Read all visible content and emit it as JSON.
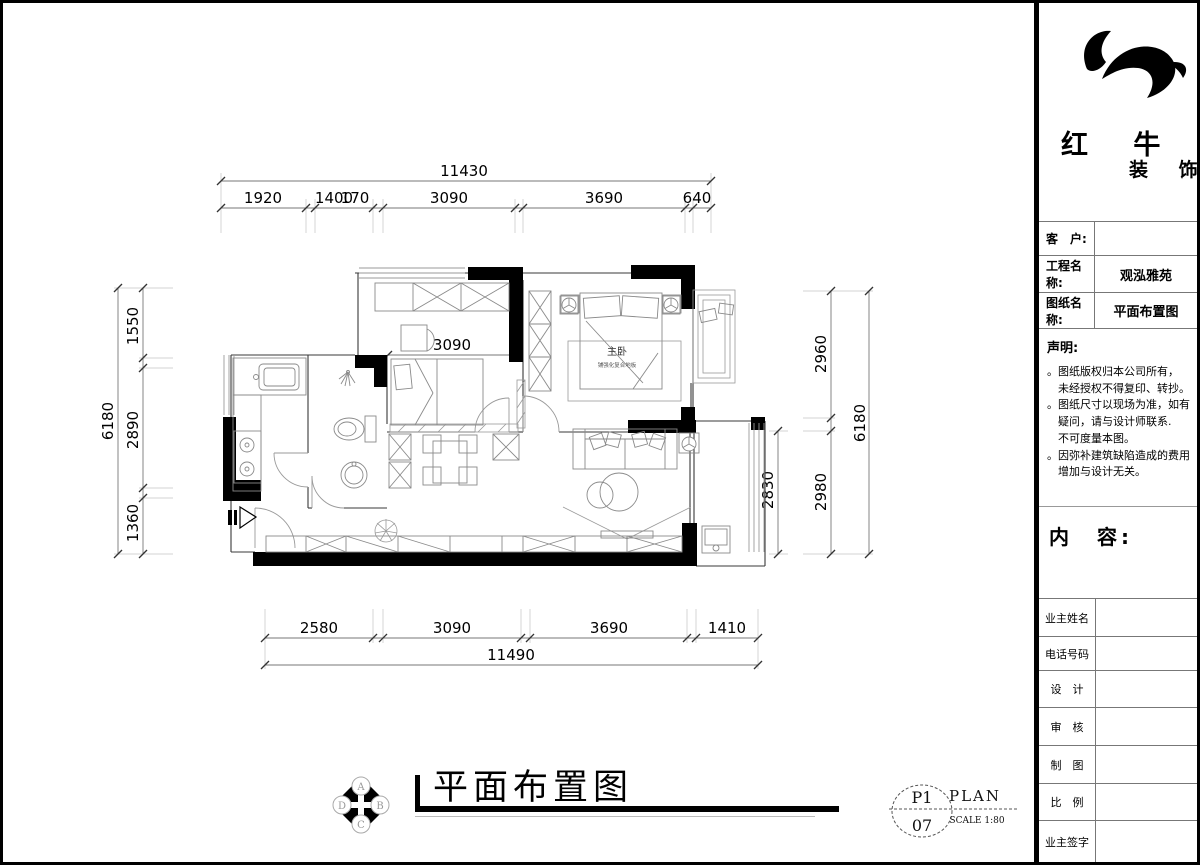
{
  "colors": {
    "ink": "#000000",
    "line_gray": "#8a8a8a",
    "bg": "#ffffff"
  },
  "plan": {
    "room_labels": {
      "master": "主卧",
      "master_sub": "铺强化复合地板"
    },
    "dims": {
      "top_total": "11430",
      "top_segs": [
        "1920",
        "1400",
        "170",
        "3090",
        "3690",
        "640"
      ],
      "bottom_segs": [
        "2580",
        "3090",
        "3690",
        "1410"
      ],
      "bottom_total": "11490",
      "left_total": "6180",
      "left_segs": [
        "1550",
        "2890",
        "1360"
      ],
      "right_segs": [
        "2960",
        "2980"
      ],
      "right_total": "6180",
      "inner_width": "3090",
      "balcony_depth": "2830"
    }
  },
  "footer": {
    "compass": {
      "letters": [
        "A",
        "B",
        "C",
        "D"
      ]
    },
    "title": "平面布置图",
    "sheet": {
      "page": "P1",
      "number": "07",
      "plan_label": "PLAN",
      "scale_label": "SCALE 1:80"
    }
  },
  "sidebar": {
    "logo": {
      "name": "红 牛",
      "suffix": "装 饰"
    },
    "fields": [
      {
        "label": "客　户:",
        "value": ""
      },
      {
        "label": "工程名称:",
        "value": "观泓雅苑"
      },
      {
        "label": "图纸名称:",
        "value": "平面布置图"
      }
    ],
    "statement": {
      "title": "声明:",
      "lines": [
        "。图纸版权归本公司所有，",
        "　未经授权不得复印、转抄。",
        "。图纸尺寸以现场为准，如有",
        "　疑问，请与设计师联系.",
        "　不可度量本图。",
        "。因弥补建筑缺陷造成的费用",
        "　增加与设计无关。"
      ]
    },
    "content_label": "内　容:",
    "rows": [
      {
        "label": "业主姓名",
        "value": ""
      },
      {
        "label": "电话号码",
        "value": ""
      },
      {
        "label": "设　计",
        "value": ""
      },
      {
        "label": "审　核",
        "value": ""
      },
      {
        "label": "制　图",
        "value": ""
      },
      {
        "label": "比　例",
        "value": ""
      },
      {
        "label": "业主签字",
        "value": ""
      }
    ]
  }
}
